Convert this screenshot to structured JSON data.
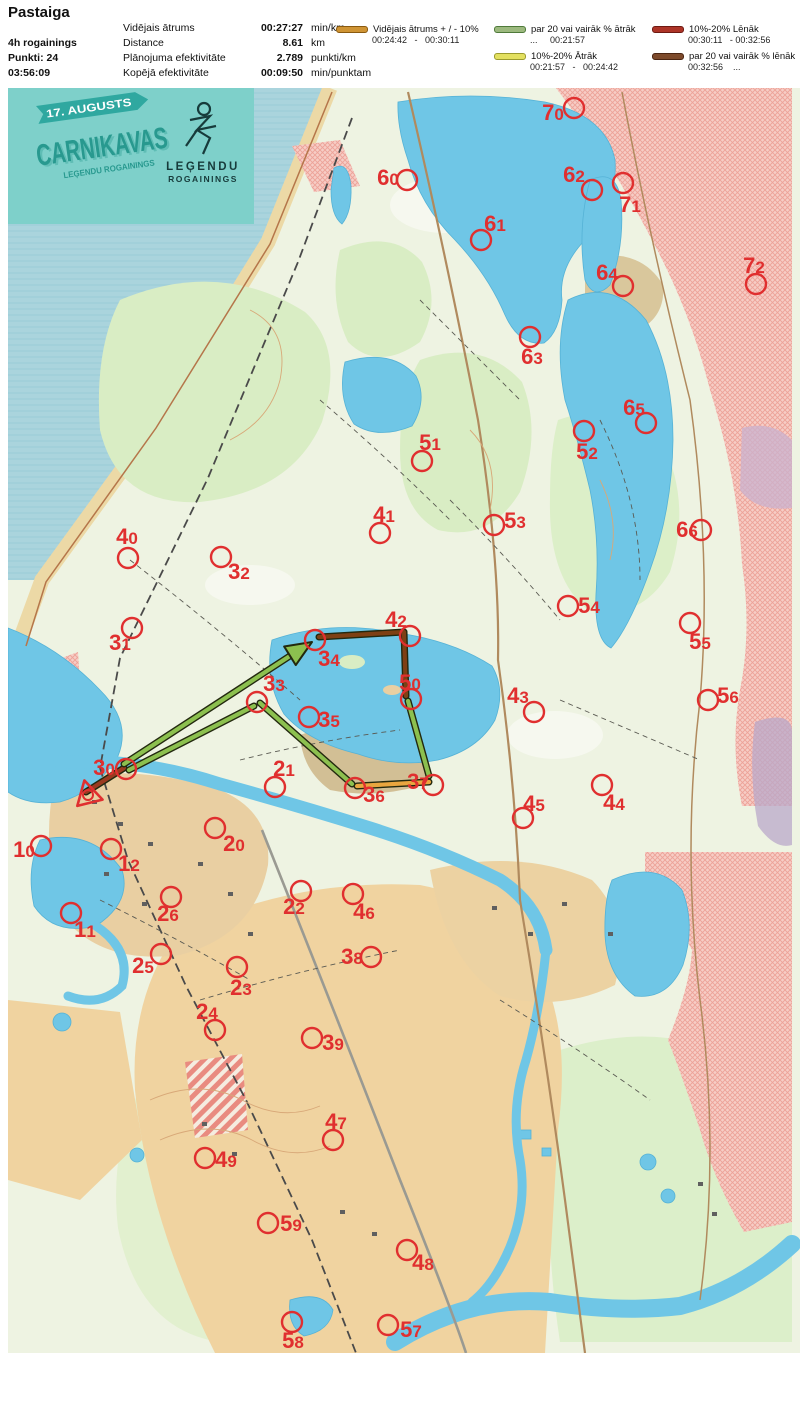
{
  "title": "Pastaiga",
  "header": {
    "meta": [
      "4h rogainings",
      "Punkti: 24",
      "03:56:09"
    ],
    "stats": [
      {
        "label": "Vidējais ātrums",
        "value": "00:27:27",
        "unit": "min/km"
      },
      {
        "label": "Distance",
        "value": "8.61",
        "unit": "km"
      },
      {
        "label": "Plānojuma efektivitāte",
        "value": "2.789",
        "unit": "punkti/km"
      },
      {
        "label": "Kopējā efektivitāte",
        "value": "00:09:50",
        "unit": "min/punktam"
      }
    ],
    "legend": [
      {
        "color": "#cf9434",
        "border": "#8a5a10",
        "label": "Vidējais ātrums + / - 10%",
        "range": "00:24:42   -   00:30:11"
      },
      {
        "color": "#9cb97e",
        "border": "#4f7a3a",
        "label": "par 20 vai vairāk % ātrāk",
        "range": "...     00:21:57"
      },
      {
        "color": "#e3e060",
        "border": "#9b9b2e",
        "label": "10%-20% Ātrāk",
        "range": "00:21:57   -   00:24:42"
      },
      {
        "color": "#ad3427",
        "border": "#6e1a12",
        "label": "10%-20% Lēnāk",
        "range": "00:30:11   - 00:32:56"
      },
      {
        "color": "#7d4a2b",
        "border": "#4a2512",
        "label": "par 20 vai vairāk % lēnāk",
        "range": "00:32:56    ..."
      }
    ]
  },
  "banner": {
    "date": "17. AUGUSTS",
    "title": "CARNIKAVAS",
    "subtitle": "LEĢENDU ROGAININGS",
    "logo_line1": "LEĢENDU",
    "logo_line2": "ROGAININGS"
  },
  "map": {
    "marker_color": "#e02f2f",
    "colors": {
      "avg": "#e9a63f",
      "faster20": "#8cc04f",
      "faster10": "#ddd84e",
      "slower10": "#9a3a20",
      "slower20": "#7e4014",
      "outline": "#23290f"
    },
    "route": {
      "start": {
        "x": 88,
        "y": 795
      },
      "segments": [
        {
          "kind": "slower10",
          "pts": [
            [
              86,
              792
            ],
            [
              124,
              768
            ]
          ]
        },
        {
          "kind": "faster20",
          "pts": [
            [
              124,
              764
            ],
            [
              296,
              652
            ]
          ],
          "arrow": [
            312,
            642
          ]
        },
        {
          "kind": "slower20",
          "pts": [
            [
              319,
              637
            ],
            [
              404,
              632
            ]
          ]
        },
        {
          "kind": "slower20",
          "pts": [
            [
              404,
              632
            ],
            [
              406,
              696
            ]
          ]
        },
        {
          "kind": "faster20",
          "pts": [
            [
              408,
              701
            ],
            [
              429,
              776
            ]
          ]
        },
        {
          "kind": "avg",
          "pts": [
            [
              429,
              782
            ],
            [
              357,
              786
            ]
          ]
        },
        {
          "kind": "faster20",
          "pts": [
            [
              352,
              784
            ],
            [
              260,
              703
            ]
          ]
        },
        {
          "kind": "faster20",
          "pts": [
            [
              254,
              706
            ],
            [
              129,
              770
            ]
          ]
        }
      ]
    },
    "controls": [
      [
        "70",
        574,
        108,
        553,
        120
      ],
      [
        "60",
        407,
        180,
        388,
        185
      ],
      [
        "62",
        592,
        190,
        574,
        182
      ],
      [
        "71",
        623,
        183,
        630,
        212
      ],
      [
        "61",
        481,
        240,
        495,
        231
      ],
      [
        "64",
        623,
        286,
        607,
        280
      ],
      [
        "72",
        756,
        284,
        754,
        273
      ],
      [
        "63",
        530,
        337,
        532,
        364
      ],
      [
        "65",
        646,
        423,
        634,
        415
      ],
      [
        "52",
        584,
        431,
        587,
        459
      ],
      [
        "51",
        422,
        461,
        430,
        450
      ],
      [
        "41",
        380,
        533,
        384,
        522
      ],
      [
        "53",
        494,
        525,
        515,
        528
      ],
      [
        "66",
        701,
        530,
        687,
        537
      ],
      [
        "40",
        128,
        558,
        127,
        544
      ],
      [
        "32",
        221,
        557,
        239,
        579
      ],
      [
        "54",
        568,
        606,
        589,
        613
      ],
      [
        "55",
        690,
        623,
        700,
        649
      ],
      [
        "42",
        410,
        636,
        396,
        627
      ],
      [
        "31",
        132,
        628,
        120,
        650
      ],
      [
        "34",
        315,
        640,
        329,
        666
      ],
      [
        "33",
        257,
        702,
        274,
        691
      ],
      [
        "50",
        411,
        699,
        410,
        690
      ],
      [
        "43",
        534,
        712,
        518,
        703
      ],
      [
        "56",
        708,
        700,
        728,
        703
      ],
      [
        "35",
        309,
        717,
        329,
        727
      ],
      [
        "21",
        275,
        787,
        284,
        776
      ],
      [
        "30",
        126,
        769,
        104,
        775
      ],
      [
        "37",
        433,
        785,
        418,
        789
      ],
      [
        "36",
        355,
        788,
        374,
        802
      ],
      [
        "44",
        602,
        785,
        614,
        810
      ],
      [
        "45",
        523,
        818,
        534,
        811
      ],
      [
        "10",
        41,
        846,
        24,
        857
      ],
      [
        "20",
        215,
        828,
        234,
        851
      ],
      [
        "12",
        111,
        849,
        129,
        871
      ],
      [
        "22",
        301,
        891,
        294,
        914
      ],
      [
        "26",
        171,
        897,
        168,
        921
      ],
      [
        "46",
        353,
        894,
        364,
        919
      ],
      [
        "11",
        71,
        913,
        85,
        937
      ],
      [
        "38",
        371,
        957,
        352,
        964
      ],
      [
        "25",
        161,
        954,
        143,
        973
      ],
      [
        "23",
        237,
        967,
        241,
        995
      ],
      [
        "24",
        215,
        1030,
        207,
        1019
      ],
      [
        "39",
        312,
        1038,
        333,
        1050
      ],
      [
        "47",
        333,
        1140,
        336,
        1129
      ],
      [
        "49",
        205,
        1158,
        226,
        1167
      ],
      [
        "59",
        268,
        1223,
        291,
        1231
      ],
      [
        "48",
        407,
        1250,
        423,
        1270
      ],
      [
        "58",
        292,
        1322,
        293,
        1348
      ],
      [
        "57",
        388,
        1325,
        411,
        1337
      ]
    ]
  }
}
